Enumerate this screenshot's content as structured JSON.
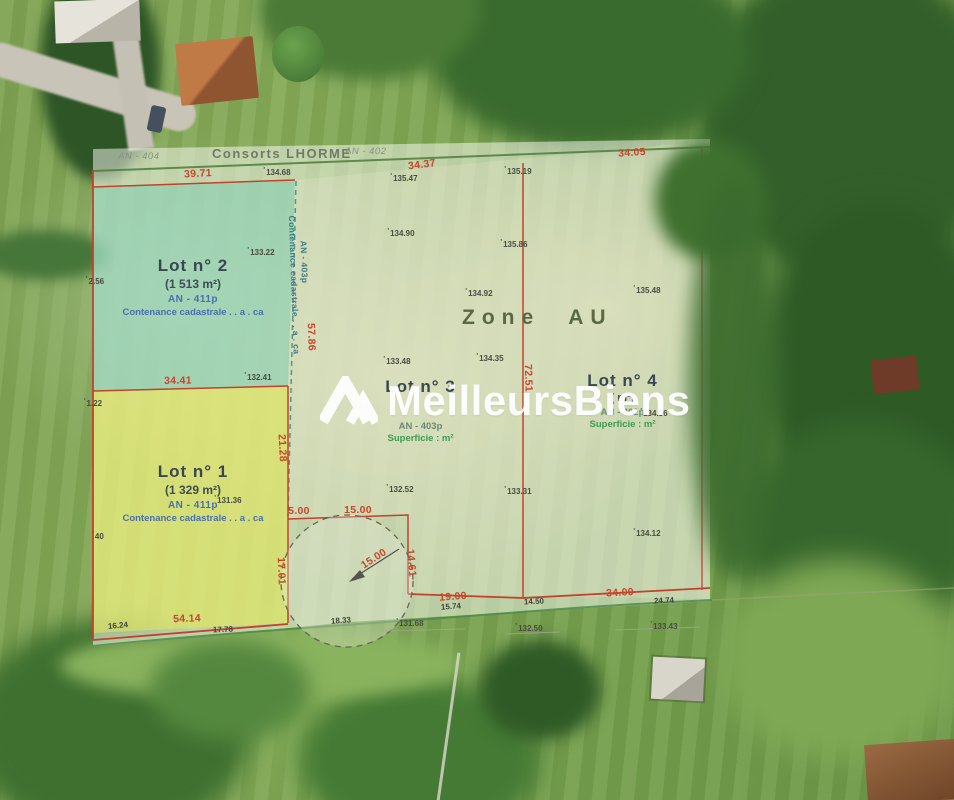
{
  "brand": {
    "watermark": "MeilleursBiens",
    "logo": "house-chevron-icon"
  },
  "colors": {
    "boundary_red": "#c2452d",
    "dimension_red": "#c8452c",
    "path_green": "#4c8a4c",
    "lot2_fill_teal": "#8fd0b8",
    "lot1_fill_yellow": "#e6ea7a",
    "overlay_white": "rgba(253,253,248,0.5)",
    "note_blue": "#4a6fae",
    "note_green": "#3f9b55",
    "watermark_white": "#ffffff"
  },
  "plan": {
    "header": {
      "parcel_left": "AN - 404",
      "owner": "Consorts LHORME",
      "parcel_right": "AN - 402"
    },
    "zone": {
      "label": "Zone AU"
    },
    "lots": {
      "lot1": {
        "title": "Lot n° 1",
        "area": "(1 329 m²)",
        "parcel": "AN - 411p",
        "note": "Contenance cadastrale . . a . ca"
      },
      "lot2": {
        "title": "Lot n° 2",
        "area": "(1 513 m²)",
        "parcel": "AN - 411p",
        "note": "Contenance cadastrale . . a . ca"
      },
      "lot3": {
        "title": "Lot n° 3",
        "parcel": "AN - 403p",
        "note": "Superficie : m²"
      },
      "lot4": {
        "title": "Lot n° 4",
        "area": "( m²)",
        "parcel": "AN - 402p",
        "note": "Superficie : m²"
      }
    },
    "labels": [
      {
        "name": "dim-39-71",
        "kind": "dim",
        "text": "39.71",
        "x": 198,
        "y": 174,
        "rot": -3
      },
      {
        "name": "dim-34-37",
        "kind": "dim",
        "text": "34.37",
        "x": 422,
        "y": 165,
        "rot": -7
      },
      {
        "name": "dim-34-05",
        "kind": "dim",
        "text": "34.05",
        "x": 632,
        "y": 153,
        "rot": -4
      },
      {
        "name": "dim-34-41",
        "kind": "dim",
        "text": "34.41",
        "x": 178,
        "y": 381,
        "rot": -1
      },
      {
        "name": "dim-57-86",
        "kind": "dim",
        "text": "57.86",
        "x": 311,
        "y": 337,
        "rot": 88
      },
      {
        "name": "dim-21-28",
        "kind": "dim",
        "text": "21.28",
        "x": 282,
        "y": 448,
        "rot": 87
      },
      {
        "name": "dim-17-01",
        "kind": "dim",
        "text": "17.01",
        "x": 281,
        "y": 571,
        "rot": 88
      },
      {
        "name": "dim-5-00",
        "kind": "dim",
        "text": "5.00",
        "x": 299,
        "y": 511,
        "rot": 0
      },
      {
        "name": "dim-15-00",
        "kind": "dim",
        "text": "15.00",
        "x": 358,
        "y": 510,
        "rot": 0
      },
      {
        "name": "dim-14-61",
        "kind": "dim",
        "text": "14.61",
        "x": 411,
        "y": 563,
        "rot": 85
      },
      {
        "name": "dim-19-00",
        "kind": "dim",
        "text": "19.00",
        "x": 453,
        "y": 597,
        "rot": -4
      },
      {
        "name": "dim-34-00",
        "kind": "dim",
        "text": "34.00",
        "x": 620,
        "y": 593,
        "rot": -3
      },
      {
        "name": "dim-54-14",
        "kind": "dim",
        "text": "54.14",
        "x": 187,
        "y": 619,
        "rot": -2
      },
      {
        "name": "dim-72-51",
        "kind": "dim",
        "text": "72.51",
        "x": 528,
        "y": 378,
        "rot": 88
      },
      {
        "name": "dim-radius-15-00",
        "kind": "dim",
        "text": "15.00",
        "x": 374,
        "y": 559,
        "rot": -33
      },
      {
        "name": "seg-16-24",
        "kind": "seg",
        "text": "16.24",
        "x": 118,
        "y": 626,
        "rot": -5
      },
      {
        "name": "seg-17-78",
        "kind": "seg",
        "text": "17.78",
        "x": 223,
        "y": 630,
        "rot": -2
      },
      {
        "name": "seg-18-33",
        "kind": "seg",
        "text": "18.33",
        "x": 341,
        "y": 621,
        "rot": -4
      },
      {
        "name": "seg-15-74",
        "kind": "seg",
        "text": "15.74",
        "x": 451,
        "y": 607,
        "rot": -4
      },
      {
        "name": "seg-14-50",
        "kind": "seg",
        "text": "14.50",
        "x": 534,
        "y": 602,
        "rot": -3
      },
      {
        "name": "seg-24-74",
        "kind": "seg",
        "text": "24.74",
        "x": 664,
        "y": 601,
        "rot": -3
      },
      {
        "name": "spot-134-68",
        "kind": "elev",
        "text": "134.68",
        "x": 277,
        "y": 172,
        "rot": 0
      },
      {
        "name": "spot-135-47",
        "kind": "elev",
        "text": "135.47",
        "x": 404,
        "y": 178,
        "rot": 0
      },
      {
        "name": "spot-135-19",
        "kind": "elev",
        "text": "135.19",
        "x": 518,
        "y": 171,
        "rot": 0
      },
      {
        "name": "spot-133-22",
        "kind": "elev",
        "text": "133.22",
        "x": 261,
        "y": 252,
        "rot": 0
      },
      {
        "name": "spot-2-56",
        "kind": "elev",
        "text": "2.56",
        "x": 95,
        "y": 281,
        "rot": 0
      },
      {
        "name": "spot-134-90",
        "kind": "elev",
        "text": "134.90",
        "x": 401,
        "y": 233,
        "rot": 0
      },
      {
        "name": "spot-135-86",
        "kind": "elev",
        "text": "135.86",
        "x": 514,
        "y": 244,
        "rot": 0
      },
      {
        "name": "spot-134-92",
        "kind": "elev",
        "text": "134.92",
        "x": 479,
        "y": 293,
        "rot": 0
      },
      {
        "name": "spot-135-48",
        "kind": "elev",
        "text": "135.48",
        "x": 647,
        "y": 290,
        "rot": 0
      },
      {
        "name": "spot-133-48",
        "kind": "elev",
        "text": "133.48",
        "x": 397,
        "y": 361,
        "rot": 0
      },
      {
        "name": "spot-134-35",
        "kind": "elev",
        "text": "134.35",
        "x": 490,
        "y": 358,
        "rot": 0
      },
      {
        "name": "spot-132-41",
        "kind": "elev",
        "text": "132.41",
        "x": 258,
        "y": 377,
        "rot": 0
      },
      {
        "name": "spot-1-22",
        "kind": "elev",
        "text": "1.22",
        "x": 93,
        "y": 403,
        "rot": 0
      },
      {
        "name": "spot-131-36",
        "kind": "elev",
        "text": "131.36",
        "x": 228,
        "y": 500,
        "rot": 0
      },
      {
        "name": "spot-132-52",
        "kind": "elev",
        "text": "132.52",
        "x": 400,
        "y": 489,
        "rot": 0
      },
      {
        "name": "spot-133-31",
        "kind": "elev",
        "text": "133.31",
        "x": 518,
        "y": 491,
        "rot": 0
      },
      {
        "name": "spot-134-36",
        "kind": "elev",
        "text": "134.36",
        "x": 654,
        "y": 413,
        "rot": 0
      },
      {
        "name": "spot-134-12",
        "kind": "elev",
        "text": "134.12",
        "x": 647,
        "y": 533,
        "rot": 0
      },
      {
        "name": "spot-40",
        "kind": "elev",
        "text": "40",
        "x": 98,
        "y": 536,
        "rot": 0
      },
      {
        "name": "spot-131-68",
        "kind": "elev",
        "text": "131.68",
        "x": 410,
        "y": 623,
        "rot": 0
      },
      {
        "name": "spot-132-50",
        "kind": "elev",
        "text": "132.50",
        "x": 529,
        "y": 628,
        "rot": 0
      },
      {
        "name": "spot-133-43",
        "kind": "elev",
        "text": "133.43",
        "x": 664,
        "y": 626,
        "rot": 0
      },
      {
        "name": "boundary-parcel-id",
        "kind": "vparcel",
        "text": "AN - 403p",
        "x": 304,
        "y": 262,
        "rot": 88
      },
      {
        "name": "boundary-parcel-note",
        "kind": "vparcel",
        "text": "Contenance cadastrale . . a . ca",
        "x": 294,
        "y": 285,
        "rot": 88
      }
    ]
  }
}
